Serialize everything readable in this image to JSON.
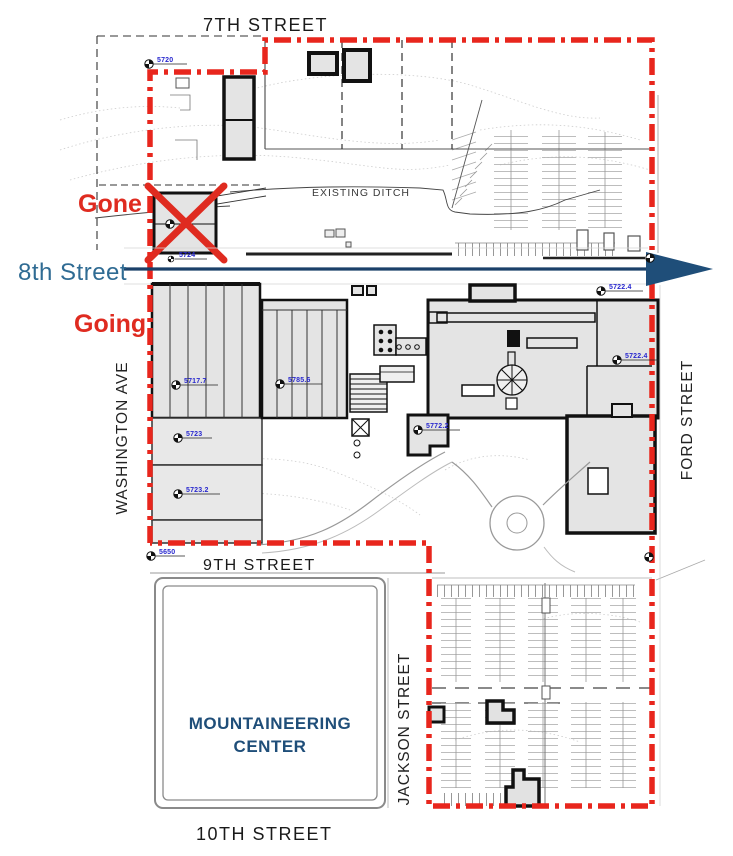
{
  "streets": {
    "seventh": "7TH STREET",
    "eighth": "8th Street",
    "ninth": "9TH STREET",
    "tenth": "10TH STREET",
    "washington_ave": "WASHINGTON AVE",
    "ford": "FORD STREET",
    "jackson": "JACKSON STREET"
  },
  "annotations": {
    "gone": "Gone",
    "going": "Going",
    "existing_ditch": "EXISTING DITCH",
    "mountaineering_center_line1": "MOUNTAINEERING",
    "mountaineering_center_line2": "CENTER"
  },
  "elevation_markers": [
    {
      "label": "5720"
    },
    {
      "label": "5724"
    },
    {
      "label": "5717.7"
    },
    {
      "label": "5785.6"
    },
    {
      "label": "5723"
    },
    {
      "label": "5723.2"
    },
    {
      "label": "5772.2"
    },
    {
      "label": "5722.4"
    },
    {
      "label": "5722.4"
    },
    {
      "label": "5650"
    }
  ],
  "colors": {
    "boundary_red": "#E8261D",
    "annotation_red": "#DF2B20",
    "street_text_blue": "#2F6B93",
    "arrow_navy": "#1B4069",
    "center_navy": "#1F4E79",
    "marker_blue": "#2727CE",
    "building_fill": "#E4E4E4"
  }
}
